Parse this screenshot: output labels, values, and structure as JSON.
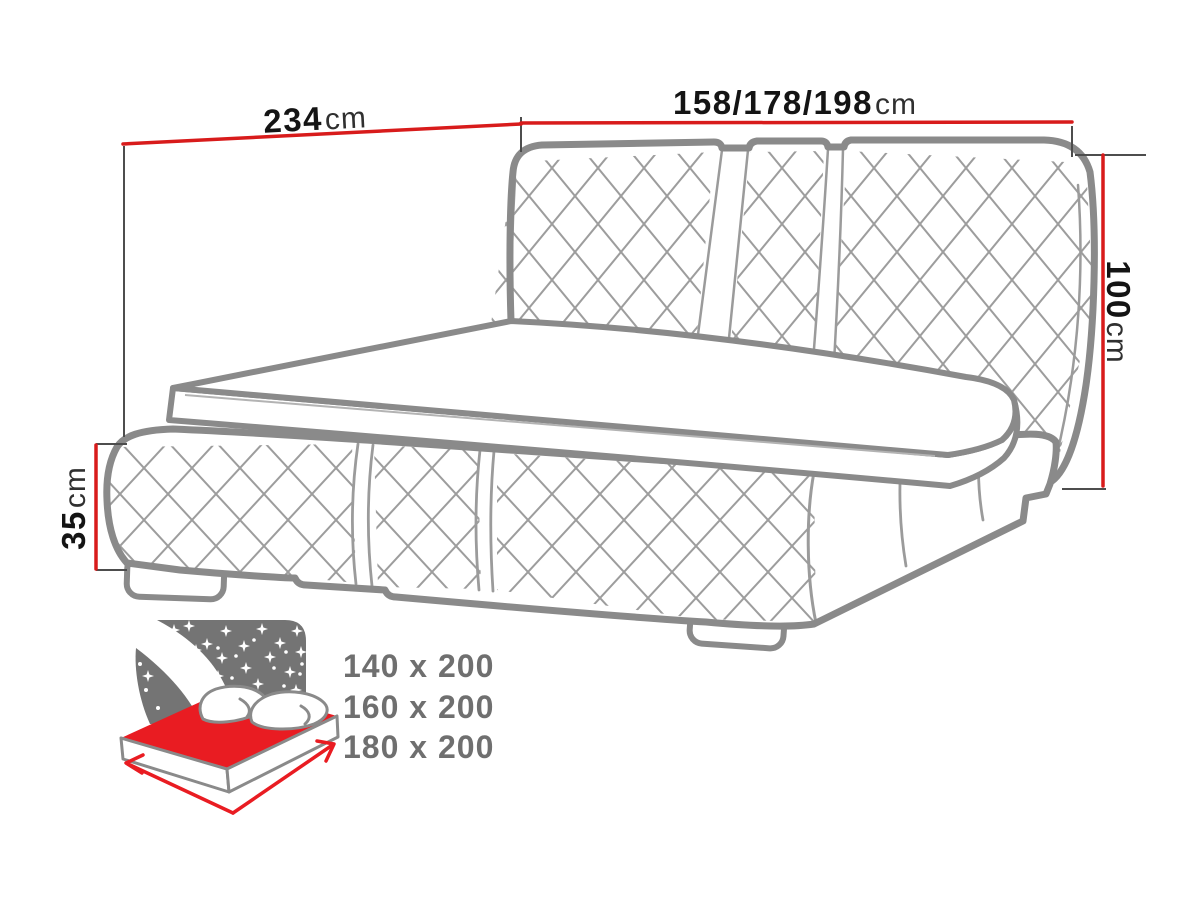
{
  "drawing": {
    "title": "upholstered bed technical drawing",
    "dimensions": {
      "length": {
        "value": "234",
        "unit": "cm"
      },
      "width": {
        "value": "158/178/198",
        "unit": "cm"
      },
      "headboard_height": {
        "value": "100",
        "unit": "cm"
      },
      "frame_height": {
        "value": "35",
        "unit": "cm"
      }
    }
  },
  "size_options": {
    "items": [
      "140 x 200",
      "160 x 200",
      "180 x 200"
    ]
  },
  "icon": {
    "name": "mattress-size-bed-icon",
    "parts": [
      "starry-night-headboard",
      "red-mattress-top",
      "pillows",
      "length-arrow",
      "width-arrow"
    ]
  },
  "colors": {
    "dimension_line_red": "#d81b1b",
    "tick_gray": "#4d4d4d",
    "outline_gray": "#8a8a8a",
    "quilting_gray": "#9d9d9d",
    "label_text": "#141414",
    "unit_text": "#303030",
    "size_text_gray": "#6f6f6f",
    "icon_gray": "#747474",
    "icon_red": "#e91c22",
    "background": "#ffffff"
  }
}
